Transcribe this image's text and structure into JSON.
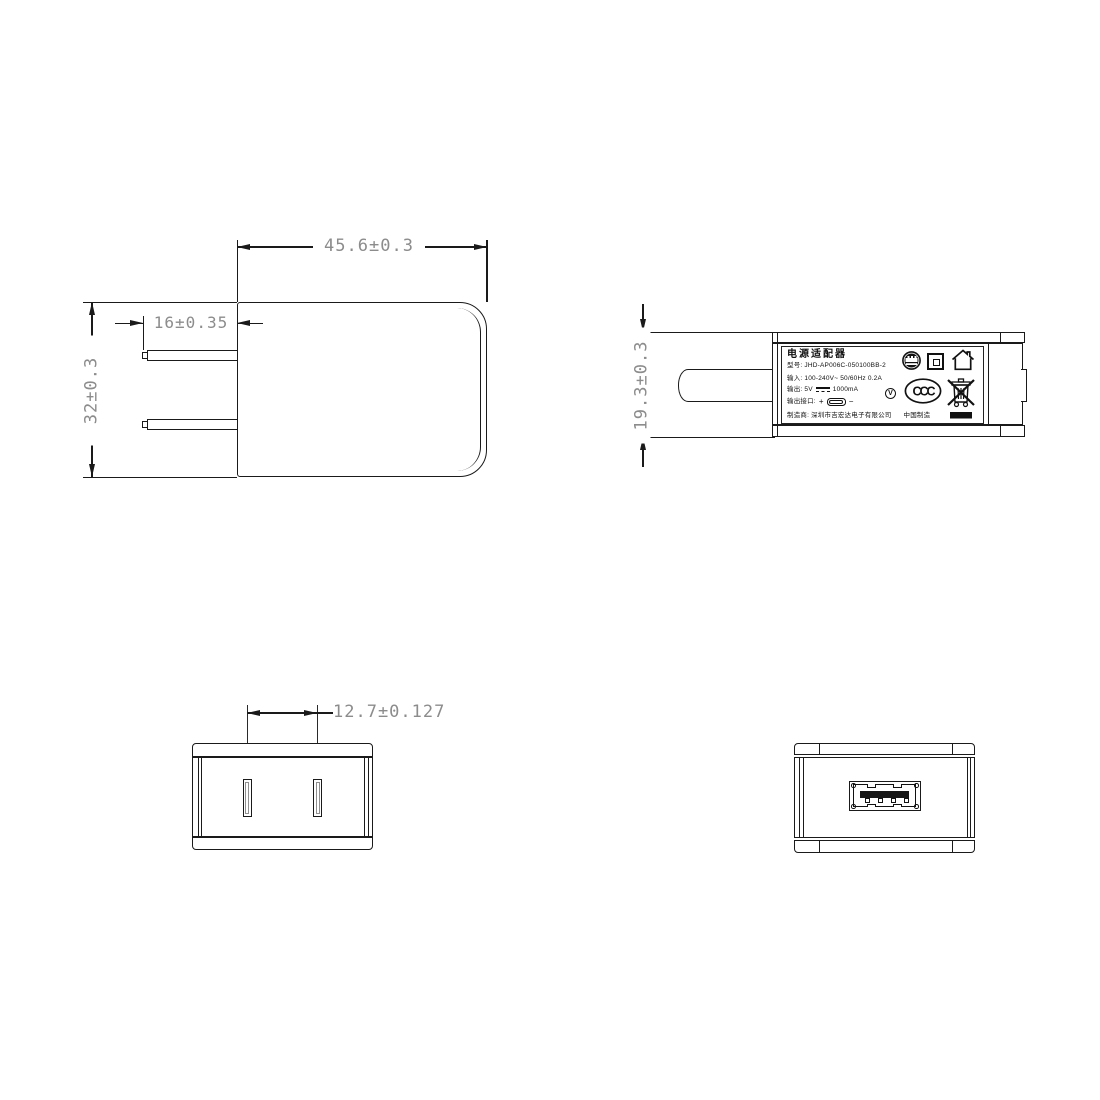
{
  "drawing_type": "technical-dimension-drawing",
  "colors": {
    "line": "#1a1a1a",
    "dim_text": "#8c8c8c",
    "fill_black": "#111111"
  },
  "dimensions": {
    "body_width": "45.6±0.3",
    "pin_length": "16±0.35",
    "body_height": "32±0.3",
    "body_thickness": "19.3±0.3",
    "pin_spacing": "12.7±0.127"
  },
  "label": {
    "title": "电源适配器",
    "model_line": "型号: JHD-AP006C-050100BB-2",
    "input_line": "输入: 100-240V~  50/60Hz  0.2A",
    "output_prefix": "输出: 5V",
    "output_suffix": "1000mA",
    "output_full": "输出: 5V ⎓ 1000mA",
    "port_label": "输出接口:",
    "plus": "+",
    "minus": "−",
    "manufacturer_line": "制造商: 深圳市吉宏达电子有限公司",
    "made_in": "中国制造"
  },
  "icons": {
    "v_text": "V",
    "ccc_text": "CCC"
  }
}
